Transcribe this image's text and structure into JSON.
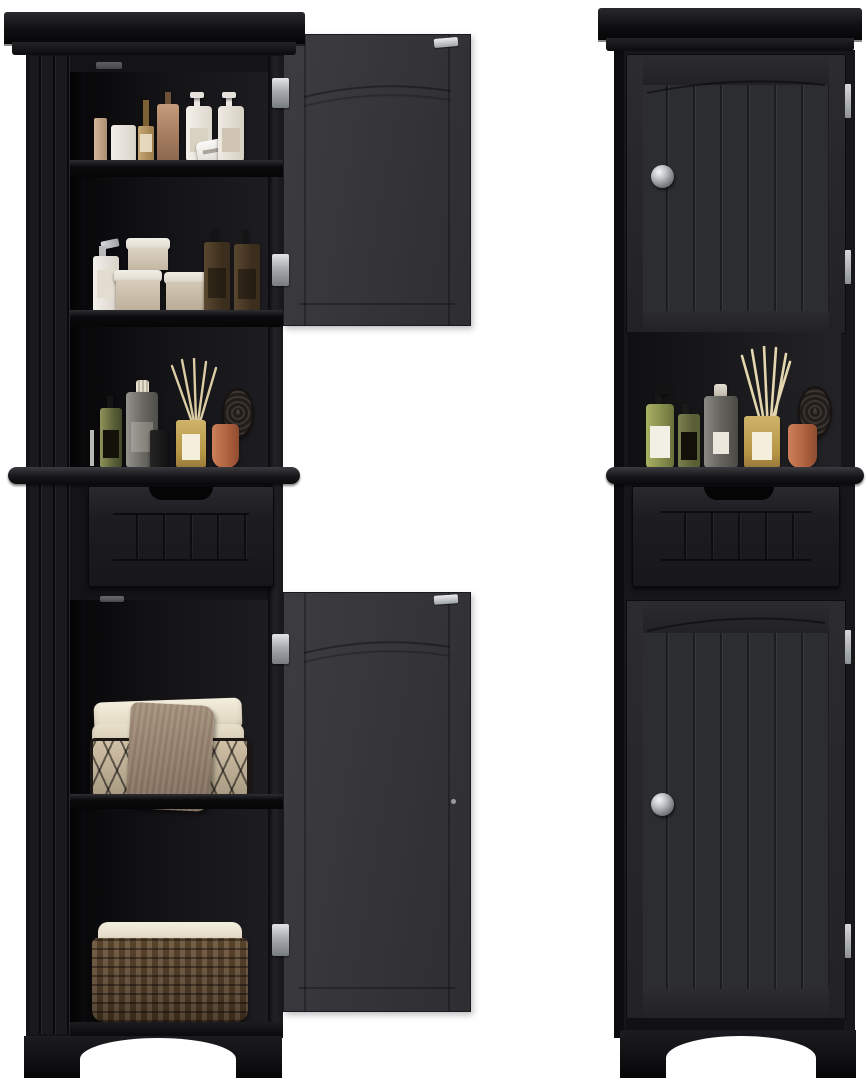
{
  "scene": {
    "subject": "Product photo: tall black freestanding bathroom storage linen cabinet, shown in two views on a white background",
    "background_color": "#ffffff",
    "views": [
      {
        "name": "doors-open",
        "label": "Front view with both doors open, styled with bath items, towels and baskets"
      },
      {
        "name": "doors-closed",
        "label": "Front view with both beadboard doors closed"
      }
    ],
    "cabinet_features": {
      "crown": "crown molding top",
      "doors": "arched-frame beadboard doors",
      "drawer": "single drawer with scooped finger-pull cutout and beadboard face",
      "open_niche": "open middle display shelf",
      "base": "plinth base with arched cutout between feet",
      "hardware": [
        "round brushed-metal knobs",
        "metal hinges",
        "metal door catch plates"
      ]
    },
    "palette": {
      "cabinet_black": "#141417",
      "door_face": "#27272b",
      "door_inner_face": "#39393d",
      "groove_dark": "#0c0c0e",
      "knob_silver": "#c3c6c9",
      "hinge_silver": "#a7abb0",
      "towel_cream": "#ece4d2",
      "towel_taupe": "#9c8876",
      "wicker_brown": "#5d4630",
      "liner_cream": "#efe8d8",
      "terracotta": "#b0633f",
      "diffuser_gold": "#c2a45f",
      "amber_glass": "#4a3a29",
      "sage_green_glass": "#9aa35e",
      "white_bottle": "#efece6"
    },
    "open_view_contents": {
      "top_shelf": [
        "beige slim bottle",
        "white jar",
        "gold pump bottle",
        "bronze pump bottle",
        "white lotion pump bottle",
        "white shaver",
        "white lotion pump bottle"
      ],
      "second_shelf": [
        "white pump dispenser",
        "stack of three cream jars with white lids",
        "amber glass pump bottle",
        "amber glass pump bottle"
      ],
      "open_niche": [
        "chartreuse glass bottle with black label",
        "clear bottle with ribbed white cap",
        "small dark bottle",
        "gold reed diffuser with cream reeds",
        "round mesh brush with terracotta handle"
      ],
      "lower_cupboard": [
        "wire basket with folded cream towels",
        "draped taupe towel",
        "woven wicker basket with cream fabric liner"
      ]
    },
    "closed_view_contents": {
      "open_niche": [
        "sage green pump bottle with white label",
        "olive bottle with black label",
        "clear stoppered bottle with white label",
        "gold reed diffuser with cream reeds",
        "round mesh paddle brush",
        "terracotta cup"
      ]
    }
  }
}
